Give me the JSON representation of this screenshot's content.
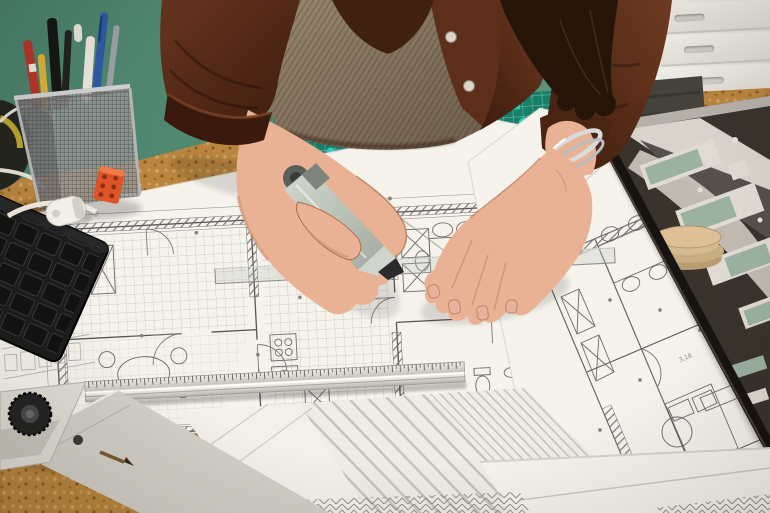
{
  "scene": {
    "title": "Architect drawing on blueprints at a cork desk",
    "objects": {
      "wall": {
        "label": "sage green wall"
      },
      "drawers": {
        "label": "white drawer cabinet"
      },
      "desk": {
        "label": "cork desk surface"
      },
      "mat": {
        "label": "green self-healing cutting mat"
      },
      "chair": {
        "label": "office chair back"
      },
      "main_plan": {
        "label": "large floor plan blueprint sheet"
      },
      "right_plan": {
        "label": "second tilted floor plan sheet"
      },
      "bottom_papers": {
        "label": "stacked drawing sheets with hatching"
      },
      "keyboard": {
        "label": "black computer keyboard"
      },
      "basket": {
        "label": "wire mesh pen cup with pens and pencils"
      },
      "clip": {
        "label": "orange binder clip"
      },
      "tape_measure": {
        "label": "tape measure at desk edge"
      },
      "tape_curl": {
        "label": "curled white measuring tape"
      },
      "roller": {
        "label": "white correction tape roller"
      },
      "ruler": {
        "label": "aluminium ruler"
      },
      "tsquare": {
        "label": "metal T-square with black knob"
      },
      "model": {
        "label": "architectural site model on black board"
      },
      "set_square": {
        "label": "transparent set square"
      },
      "person": {
        "label": "architect torso in brown shirt and knit vest"
      },
      "left_hand": {
        "label": "left hand holding grey marker"
      },
      "right_hand": {
        "label": "right hand holding set square"
      },
      "marker": {
        "label": "grey drawing marker"
      },
      "bracelet": {
        "label": "silver bangles on wrist"
      }
    },
    "floor_plan_annotations": {
      "dim_a": "1,53",
      "dim_b": "3,18"
    }
  },
  "palette": {
    "wall": "#578e76",
    "wall-shade": "#49806a",
    "cork": "#b9853f",
    "cork-light": "#d2a35f",
    "cork-dark": "#8a5a26",
    "paper": "#f6f3ed",
    "line": "#5b5b5b",
    "mat": "#17806a",
    "mat-dot": "#2fd3c4",
    "shirt": "#5d2f1b",
    "shirt-dark": "#3a1a0c",
    "shirt-light": "#7a4426",
    "vest": "#8d7d69",
    "vest-dark": "#6d5e4b",
    "skin": "#e9b294",
    "skin-shadow": "#c98e6e",
    "skin-dark": "#a96d4f",
    "hair": "#261409",
    "keyboard": "#1c1c1c",
    "metal": "#d6d3cb",
    "metal-dark": "#a39f96",
    "marker": "#bfc7bd",
    "marker-dark": "#8f978d",
    "nib": "#2b2b2b",
    "model-board": "#39332c",
    "model-edge": "#17130f",
    "model-white": "#e0dbd2",
    "model-green": "#9cb2a0",
    "cardboard": "#c9ae85",
    "pen-red": "#b53529",
    "pen-blue": "#2d59a4",
    "pencil-yellow": "#d9b03a",
    "clip-orange": "#dd5426",
    "tape-yellow": "#c9b42e",
    "tape-body": "#23261e",
    "chair": "#44423c"
  }
}
